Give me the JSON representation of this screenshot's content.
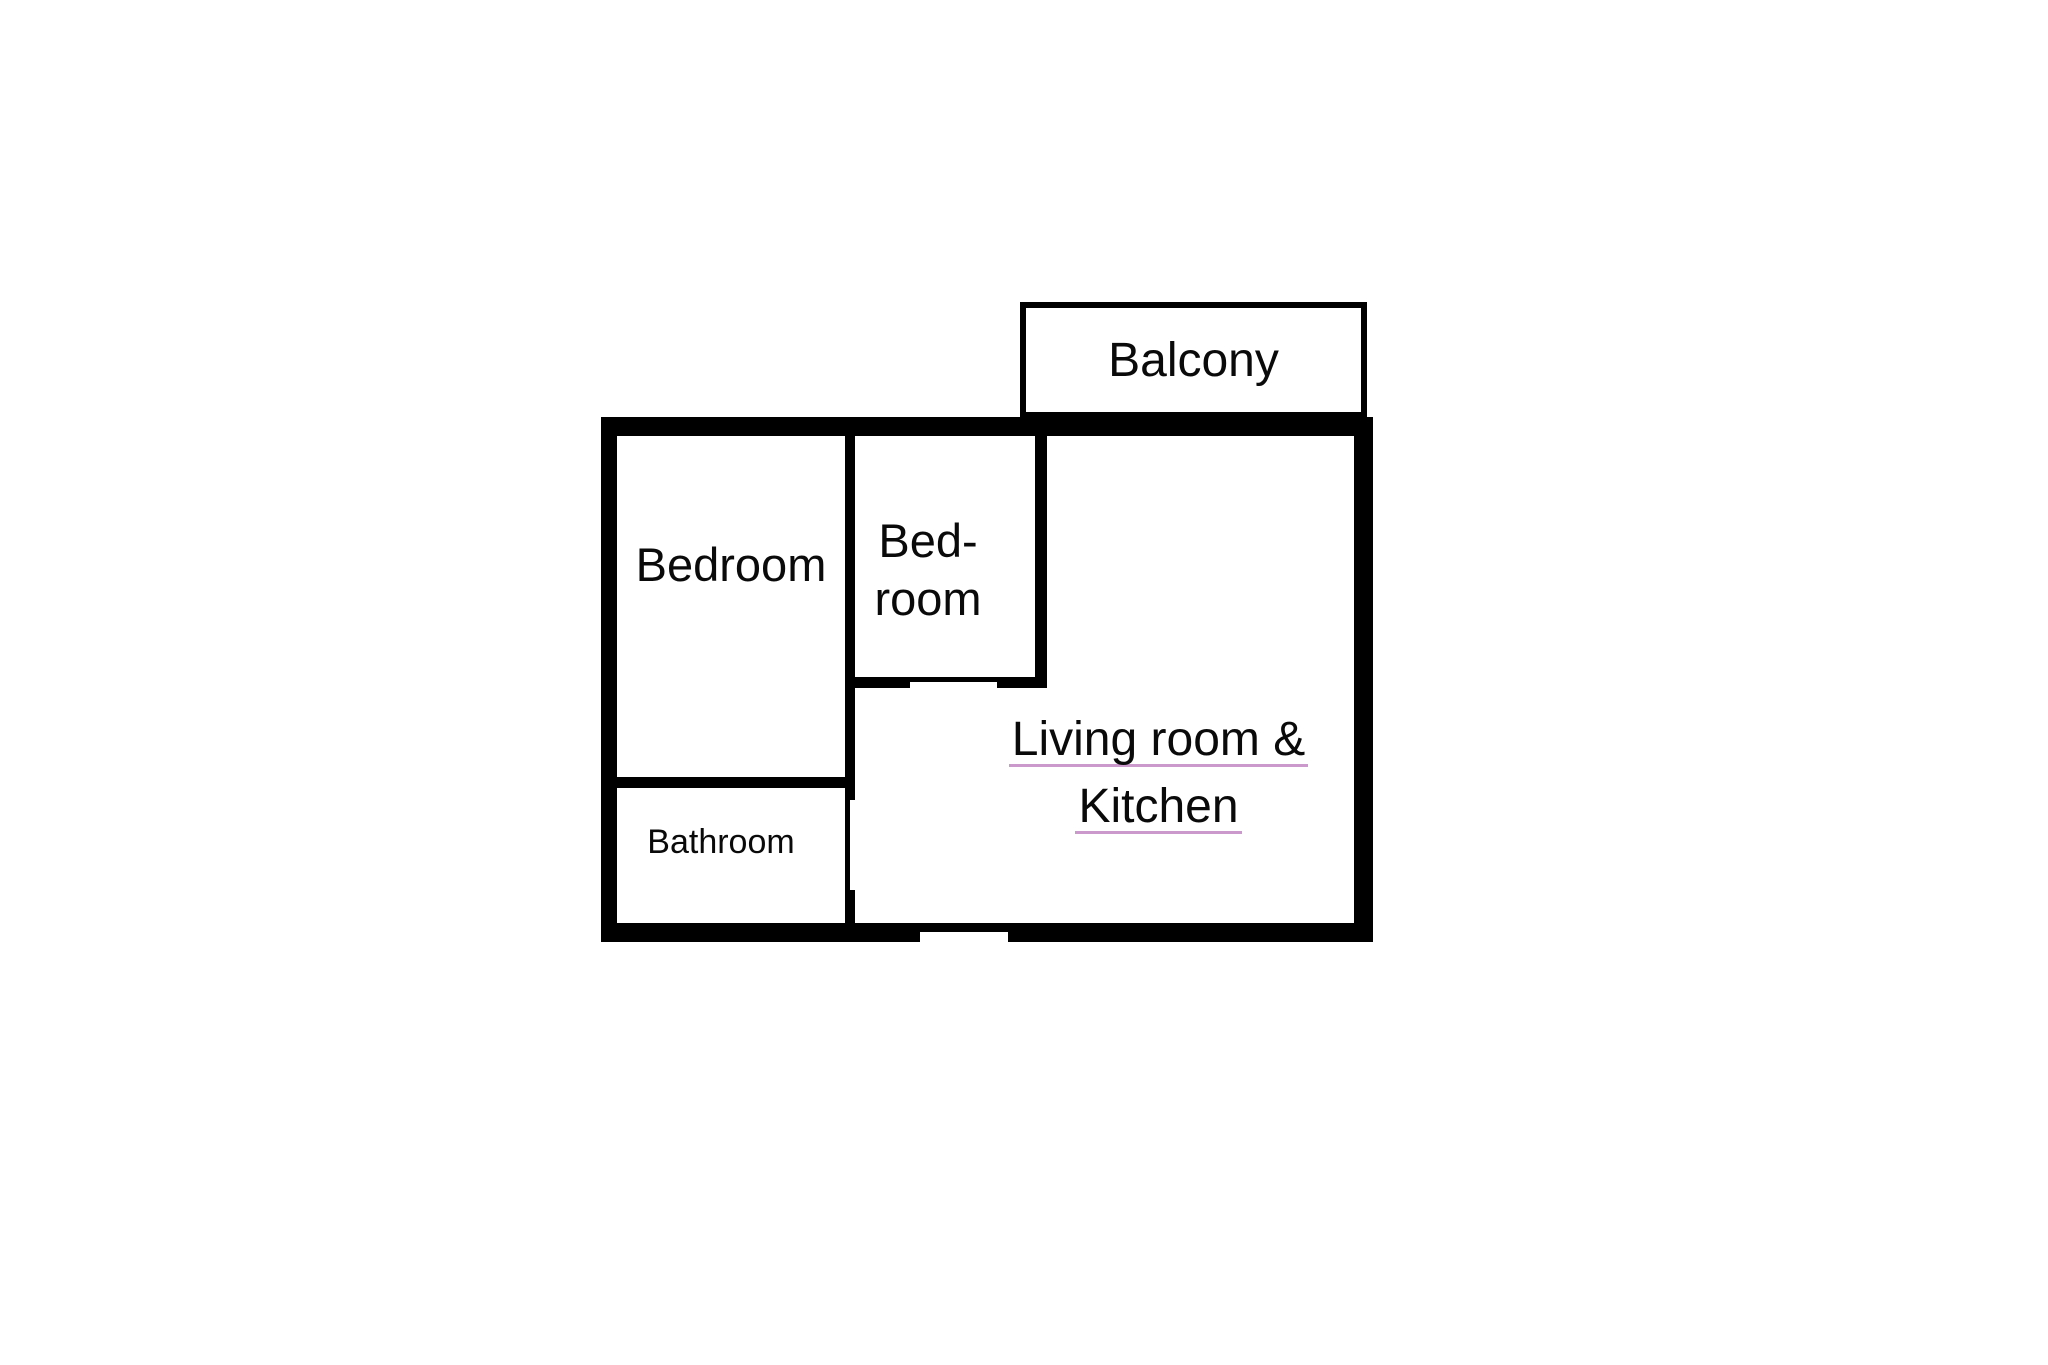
{
  "plan": {
    "rooms": {
      "balcony": {
        "label": "Balcony"
      },
      "bedroom_main": {
        "label": "Bedroom"
      },
      "bedroom_small": {
        "line1": "Bed-",
        "line2": "room"
      },
      "bathroom": {
        "label": "Bathroom"
      },
      "living_kitchen": {
        "line1": "Living room &",
        "line2": "Kitchen"
      }
    },
    "colors": {
      "wall": "#000000",
      "background": "#ffffff",
      "text": "#0a0a0a",
      "living_underline": "#cc99cc"
    }
  }
}
